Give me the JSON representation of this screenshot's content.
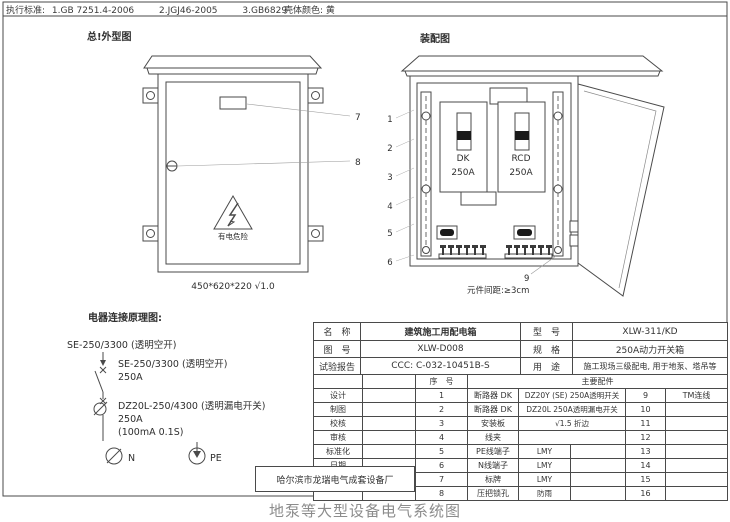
{
  "header": {
    "standards_label": "执行标准:",
    "std1": "1.GB 7251.4-2006",
    "std2": "2.JGJ46-2005",
    "std3": "3.GB6829",
    "shell_color": "壳体颜色: 黄"
  },
  "outline": {
    "title": "总!外型图",
    "warning": "有电危险",
    "dimensions": "450*620*220 √1.0",
    "callout_7": "7",
    "callout_8": "8"
  },
  "assembly": {
    "title": "装配图",
    "dk_name": "DK",
    "dk_rating": "250A",
    "rcd_name": "RCD",
    "rcd_rating": "250A",
    "spacing_note": "元件间距:≥3cm",
    "callout_9": "9",
    "callouts": [
      "1",
      "2",
      "3",
      "4",
      "5",
      "6"
    ]
  },
  "schematic": {
    "title": "电器连接原理图:",
    "top_label": "SE-250/3300 (透明空开)",
    "breaker1_model": "SE-250/3300 (透明空开)",
    "breaker1_rating": "250A",
    "breaker2_model": "DZ20L-250/4300 (透明漏电开关)",
    "breaker2_rating": "250A",
    "breaker2_leakage": "(100mA 0.1S)",
    "n_label": "N",
    "pe_label": "PE"
  },
  "title_block": {
    "name_label": "名　称",
    "name_value": "建筑施工用配电箱",
    "model_label": "型　号",
    "model_value": "XLW-311/KD",
    "drawing_no_label": "图　号",
    "drawing_no_value": "XLW-D008",
    "spec_label": "规　格",
    "spec_value": "250A动力开关箱",
    "test_report_label": "试验报告",
    "test_report_value": "CCC: C-032-10451B-S",
    "usage_label": "用　途",
    "usage_value": "施工现场三级配电, 用于地泵、塔吊等",
    "serial_label": "序　号",
    "parts_label": "主要配件",
    "rows": [
      {
        "role": "设计",
        "no": "1",
        "part": "断路器 DK",
        "spec": "DZ20Y (SE) 250A透明开关",
        "no2": "9",
        "part2": "TM连线"
      },
      {
        "role": "制图",
        "no": "2",
        "part": "断路器 DK",
        "spec": "DZ20L 250A透明漏电开关",
        "no2": "10",
        "part2": ""
      },
      {
        "role": "校核",
        "no": "3",
        "part": "安装板",
        "spec": "√1.5 折边",
        "no2": "11",
        "part2": ""
      },
      {
        "role": "审核",
        "no": "4",
        "part": "线夹",
        "spec": "",
        "no2": "12",
        "part2": ""
      },
      {
        "role": "标准化",
        "no": "5",
        "part": "PE线端子",
        "spec": "LMY",
        "no2": "13",
        "part2": ""
      },
      {
        "role": "日期",
        "no": "6",
        "part": "N线端子",
        "spec": "LMY",
        "no2": "14",
        "part2": ""
      },
      {
        "role": "",
        "no": "7",
        "part": "标牌",
        "spec": "LMY",
        "no2": "15",
        "part2": ""
      },
      {
        "role": "",
        "no": "8",
        "part": "压把锁孔",
        "spec": "防雨",
        "no2": "16",
        "part2": ""
      }
    ],
    "factory": "哈尔滨市龙瑞电气成套设备厂"
  },
  "caption": "地泵等大型设备电气系统图"
}
